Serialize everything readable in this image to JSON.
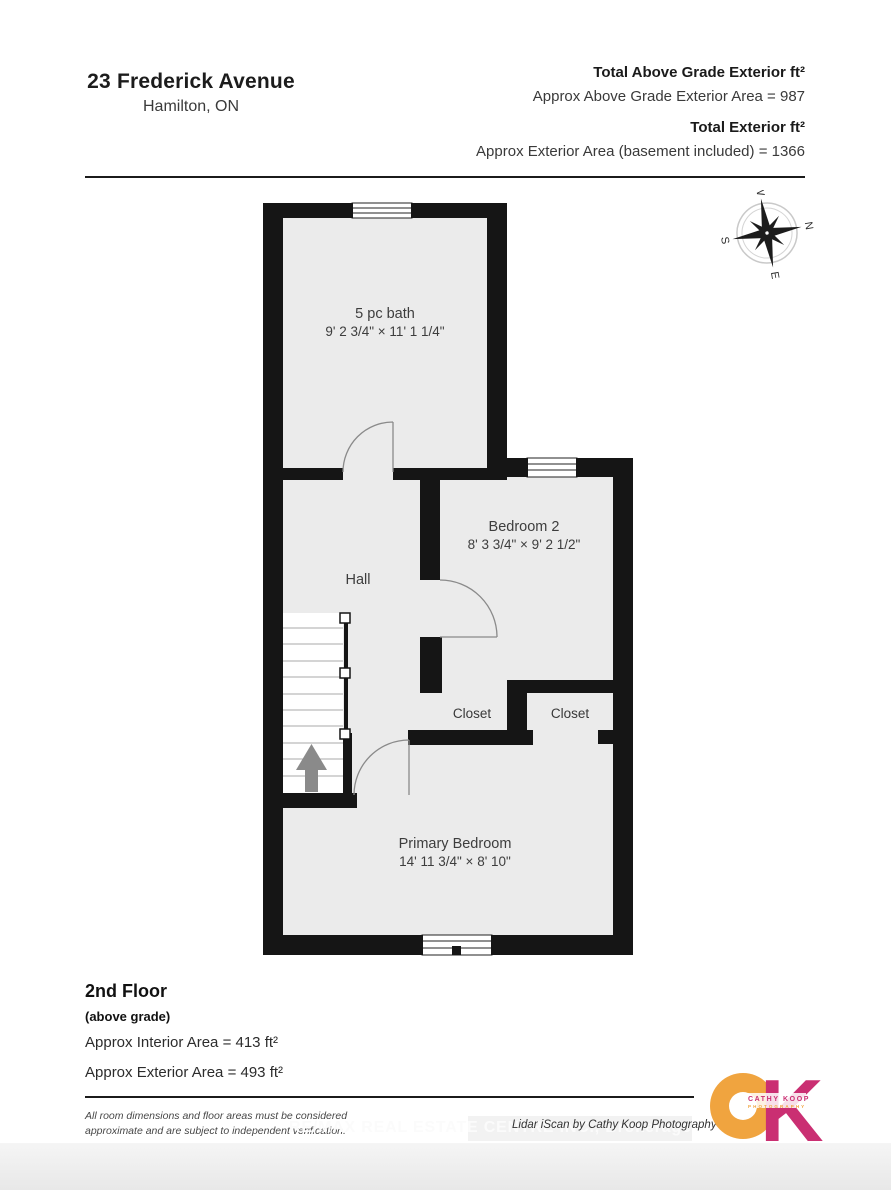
{
  "header": {
    "address": "23 Frederick Avenue",
    "city": "Hamilton, ON",
    "totals": [
      {
        "label": "Total Above Grade Exterior ft²",
        "value": "Approx Above Grade Exterior Area = 987"
      },
      {
        "label": "Total Exterior ft²",
        "value": "Approx Exterior Area (basement included) = 1366"
      }
    ]
  },
  "compass": {
    "n": "N",
    "e": "E",
    "s": "S",
    "w": "W"
  },
  "rooms": [
    {
      "name": "5 pc bath",
      "dims": "9' 2 3/4\" × 11' 1 1/4\""
    },
    {
      "name": "Bedroom 2",
      "dims": "8' 3 3/4\" × 9' 2 1/2\""
    },
    {
      "name": "Hall",
      "dims": ""
    },
    {
      "name": "Closet",
      "dims": ""
    },
    {
      "name": "Closet",
      "dims": ""
    },
    {
      "name": "Primary Bedroom",
      "dims": "14' 11 3/4\" × 8' 10\""
    }
  ],
  "footer": {
    "floor_title": "2nd Floor",
    "floor_subtitle": "(above grade)",
    "interior_area": "Approx Interior Area = 413 ft²",
    "exterior_area": "Approx Exterior Area = 493 ft²",
    "disclaimer_line1": "All room dimensions and floor areas must be considered",
    "disclaimer_line2": "approximate and are subject to independent verification.",
    "watermark": "RE/MAX REAL ESTATE CENTRE INC., Brokerage",
    "credit": "Lidar iScan by Cathy Koop Photography"
  },
  "logo": {
    "k": "K",
    "line1": "CATHY KOOP",
    "line2": "PHOTOGRAPHY",
    "orange": "#F0A43F",
    "magenta": "#CA2F72"
  }
}
